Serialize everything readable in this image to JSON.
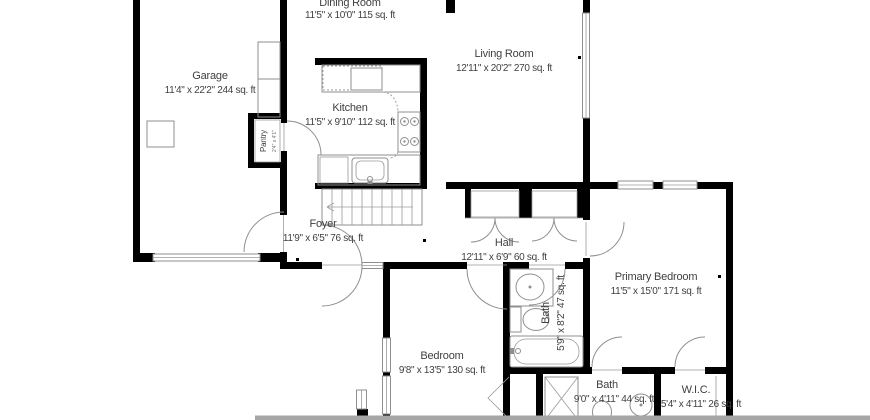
{
  "plan_title": "First floor plan",
  "colors": {
    "wall": "#000000",
    "thin_line": "#8f8f8f",
    "text": "#3f3f3f",
    "background": "#ffffff",
    "cut_band": "#a6a6a6"
  },
  "rooms": {
    "garage": {
      "name": "Garage",
      "dims": "11'4\" x 22'2\" 244 sq. ft"
    },
    "dining": {
      "name": "Dining Room",
      "dims": "11'5\" x 10'0\" 115 sq. ft"
    },
    "kitchen": {
      "name": "Kitchen",
      "dims": "11'5\" x 9'10\" 112 sq. ft"
    },
    "living": {
      "name": "Living Room",
      "dims": "12'11\" x 20'2\" 270 sq. ft"
    },
    "pantry": {
      "name": "Pantry",
      "dims": "2'4\" x 4'1\""
    },
    "foyer": {
      "name": "Foyer",
      "dims": "11'9\" x 6'5\" 76 sq. ft"
    },
    "hall": {
      "name": "Hall",
      "dims": "12'11\" x 6'9\" 60 sq. ft"
    },
    "bath_hall": {
      "name": "Bath",
      "dims": "5'9\" x 8'2\" 47 sq. ft"
    },
    "bedroom": {
      "name": "Bedroom",
      "dims": "9'8\" x 13'5\" 130 sq. ft"
    },
    "primary": {
      "name": "Primary Bedroom",
      "dims": "11'5\" x 15'0\" 171 sq. ft"
    },
    "bath_primary": {
      "name": "Bath",
      "dims": "9'0\" x 4'11\" 44 sq. ft"
    },
    "wic": {
      "name": "W.I.C.",
      "dims": "5'4\" x 4'11\" 26 sq. ft"
    }
  }
}
